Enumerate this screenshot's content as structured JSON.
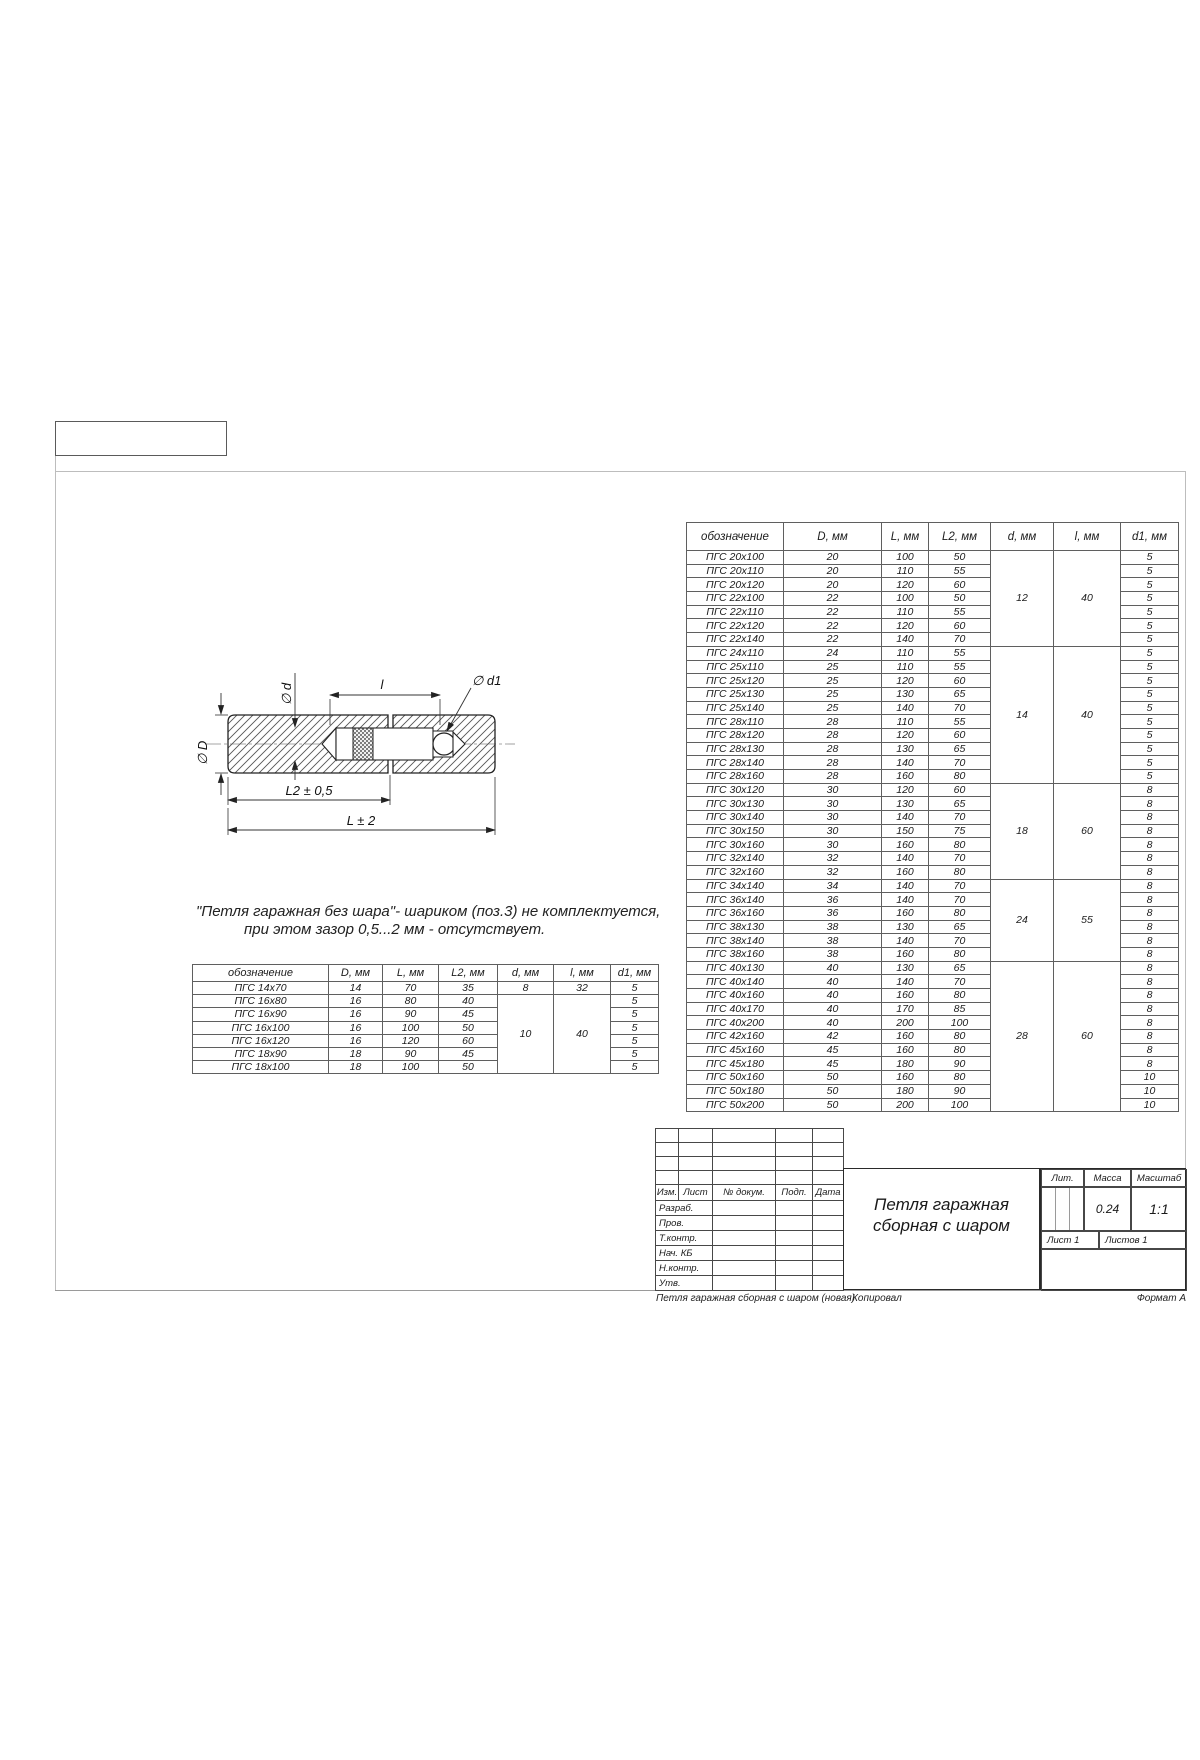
{
  "note": {
    "line1": "\"Петля гаражная без шара\"- шариком (поз.3) не комплектуется,",
    "line2": "при этом зазор 0,5...2 мм - отсутствует."
  },
  "drawing": {
    "dim_d": "∅ d",
    "dim_D": "∅ D",
    "dim_l": "l",
    "dim_d1": "∅ d1",
    "dim_L2": "L2 ± 0,5",
    "dim_L": "L ± 2"
  },
  "small_table": {
    "headers": [
      "обозначение",
      "D, мм",
      "L, мм",
      "L2, мм",
      "d, мм",
      "l, мм",
      "d1, мм"
    ],
    "rows": [
      [
        "ПГС 14x70",
        "14",
        "70",
        "35",
        "5"
      ],
      [
        "ПГС 16x80",
        "16",
        "80",
        "40",
        "5"
      ],
      [
        "ПГС 16x90",
        "16",
        "90",
        "45",
        "5"
      ],
      [
        "ПГС 16x100",
        "16",
        "100",
        "50",
        "5"
      ],
      [
        "ПГС 16x120",
        "16",
        "120",
        "60",
        "5"
      ],
      [
        "ПГС 18x90",
        "18",
        "90",
        "45",
        "5"
      ],
      [
        "ПГС 18x100",
        "18",
        "100",
        "50",
        "5"
      ]
    ],
    "groups": [
      {
        "start": 0,
        "count": 1,
        "d": "8",
        "l": "32"
      },
      {
        "start": 1,
        "count": 6,
        "d": "10",
        "l": "40"
      }
    ]
  },
  "big_table": {
    "headers": [
      "обозначение",
      "D, мм",
      "L, мм",
      "L2, мм",
      "d, мм",
      "l, мм",
      "d1, мм"
    ],
    "rows": [
      [
        "ПГС 20x100",
        "20",
        "100",
        "50",
        "5"
      ],
      [
        "ПГС 20x110",
        "20",
        "110",
        "55",
        "5"
      ],
      [
        "ПГС 20x120",
        "20",
        "120",
        "60",
        "5"
      ],
      [
        "ПГС 22x100",
        "22",
        "100",
        "50",
        "5"
      ],
      [
        "ПГС 22x110",
        "22",
        "110",
        "55",
        "5"
      ],
      [
        "ПГС 22x120",
        "22",
        "120",
        "60",
        "5"
      ],
      [
        "ПГС 22x140",
        "22",
        "140",
        "70",
        "5"
      ],
      [
        "ПГС 24x110",
        "24",
        "110",
        "55",
        "5"
      ],
      [
        "ПГС 25x110",
        "25",
        "110",
        "55",
        "5"
      ],
      [
        "ПГС 25x120",
        "25",
        "120",
        "60",
        "5"
      ],
      [
        "ПГС 25x130",
        "25",
        "130",
        "65",
        "5"
      ],
      [
        "ПГС 25x140",
        "25",
        "140",
        "70",
        "5"
      ],
      [
        "ПГС 28x110",
        "28",
        "110",
        "55",
        "5"
      ],
      [
        "ПГС 28x120",
        "28",
        "120",
        "60",
        "5"
      ],
      [
        "ПГС 28x130",
        "28",
        "130",
        "65",
        "5"
      ],
      [
        "ПГС 28x140",
        "28",
        "140",
        "70",
        "5"
      ],
      [
        "ПГС 28x160",
        "28",
        "160",
        "80",
        "5"
      ],
      [
        "ПГС 30x120",
        "30",
        "120",
        "60",
        "8"
      ],
      [
        "ПГС 30x130",
        "30",
        "130",
        "65",
        "8"
      ],
      [
        "ПГС 30x140",
        "30",
        "140",
        "70",
        "8"
      ],
      [
        "ПГС 30x150",
        "30",
        "150",
        "75",
        "8"
      ],
      [
        "ПГС 30x160",
        "30",
        "160",
        "80",
        "8"
      ],
      [
        "ПГС 32x140",
        "32",
        "140",
        "70",
        "8"
      ],
      [
        "ПГС 32x160",
        "32",
        "160",
        "80",
        "8"
      ],
      [
        "ПГС 34x140",
        "34",
        "140",
        "70",
        "8"
      ],
      [
        "ПГС 36x140",
        "36",
        "140",
        "70",
        "8"
      ],
      [
        "ПГС 36x160",
        "36",
        "160",
        "80",
        "8"
      ],
      [
        "ПГС 38x130",
        "38",
        "130",
        "65",
        "8"
      ],
      [
        "ПГС 38x140",
        "38",
        "140",
        "70",
        "8"
      ],
      [
        "ПГС 38x160",
        "38",
        "160",
        "80",
        "8"
      ],
      [
        "ПГС 40x130",
        "40",
        "130",
        "65",
        "8"
      ],
      [
        "ПГС 40x140",
        "40",
        "140",
        "70",
        "8"
      ],
      [
        "ПГС 40x160",
        "40",
        "160",
        "80",
        "8"
      ],
      [
        "ПГС 40x170",
        "40",
        "170",
        "85",
        "8"
      ],
      [
        "ПГС 40x200",
        "40",
        "200",
        "100",
        "8"
      ],
      [
        "ПГС 42x160",
        "42",
        "160",
        "80",
        "8"
      ],
      [
        "ПГС 45x160",
        "45",
        "160",
        "80",
        "8"
      ],
      [
        "ПГС 45x180",
        "45",
        "180",
        "90",
        "8"
      ],
      [
        "ПГС 50x160",
        "50",
        "160",
        "80",
        "10"
      ],
      [
        "ПГС 50x180",
        "50",
        "180",
        "90",
        "10"
      ],
      [
        "ПГС 50x200",
        "50",
        "200",
        "100",
        "10"
      ]
    ],
    "groups": [
      {
        "start": 0,
        "count": 7,
        "d": "12",
        "l": "40"
      },
      {
        "start": 7,
        "count": 10,
        "d": "14",
        "l": "40"
      },
      {
        "start": 17,
        "count": 7,
        "d": "18",
        "l": "60"
      },
      {
        "start": 24,
        "count": 6,
        "d": "24",
        "l": "55"
      },
      {
        "start": 30,
        "count": 11,
        "d": "28",
        "l": "60"
      }
    ]
  },
  "title_block": {
    "rev_headers": [
      "Изм.",
      "Лист",
      "№ докум.",
      "Подп.",
      "Дата"
    ],
    "sign_rows": [
      "Разраб.",
      "Пров.",
      "Т.контр.",
      "Нач. КБ",
      "Н.контр.",
      "Утв."
    ],
    "title_line1": "Петля гаражная",
    "title_line2": "сборная с шаром",
    "lit_label": "Лит.",
    "mass_label": "Масса",
    "scale_label": "Масштаб",
    "mass_value": "0.24",
    "scale_value": "1:1",
    "sheet_label": "Лист 1",
    "sheets_label": "Листов 1"
  },
  "footer": {
    "doc_name": "Петля гаражная сборная с шаром (новая)",
    "kopiroval": "Копировал",
    "format": "Формат А"
  }
}
